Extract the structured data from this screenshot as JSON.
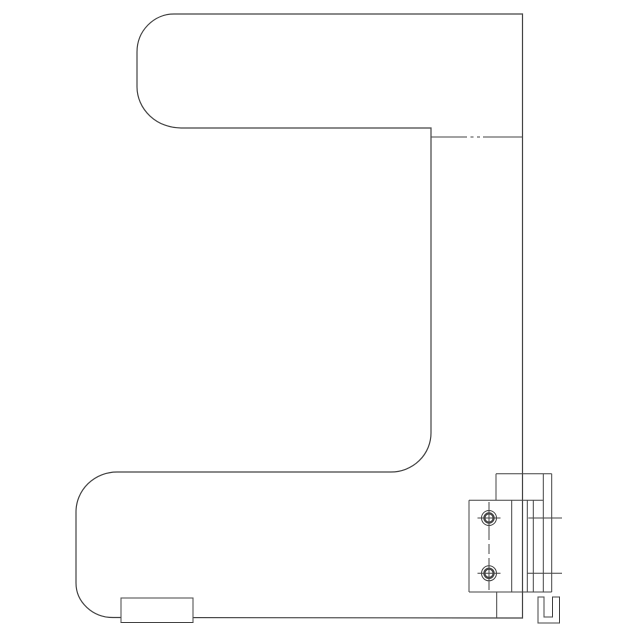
{
  "canvas": {
    "width": 640,
    "height": 640,
    "background": "#ffffff"
  },
  "style": {
    "line_color": "#444444",
    "outline_width": 1.2,
    "thin_width": 1,
    "heavy_width": 2.2,
    "white": "#ffffff"
  },
  "drawing": {
    "subject": "door-handle-side-profile-technical-drawing",
    "shapes": [
      {
        "name": "handle-outline",
        "kind": "path",
        "w": 1.2,
        "d": "M 174 14 L 522.5 14 L 522.5 618 L 113 617.5 A 37 34.5 0 0 1 76 583 L 76 512 A 41 40 0 0 1 117 472 L 391 472 A 40 39 0 0 0 431 433 L 431 128 L 181 128 A 44 41.3 0 0 1 137 87 L 137 52 A 37 38 0 0 1 174 14 Z"
      },
      {
        "name": "neck-shoulder-line-left",
        "kind": "line",
        "x1": 431,
        "y1": 137,
        "x2": 467,
        "y2": 137
      },
      {
        "name": "neck-shoulder-dash-a",
        "kind": "line",
        "x1": 470.5,
        "y1": 137,
        "x2": 473.5,
        "y2": 137
      },
      {
        "name": "neck-shoulder-dash-b",
        "kind": "line",
        "x1": 477,
        "y1": 137,
        "x2": 480,
        "y2": 137
      },
      {
        "name": "neck-shoulder-line-right",
        "kind": "line",
        "x1": 483,
        "y1": 137,
        "x2": 522,
        "y2": 137
      },
      {
        "name": "bracket-cap-top-line",
        "kind": "line",
        "x1": 496,
        "y1": 473.7,
        "x2": 551.7,
        "y2": 473.7
      },
      {
        "name": "bracket-cap-left-line",
        "kind": "line",
        "x1": 496,
        "y1": 473.7,
        "x2": 496,
        "y2": 500.3
      },
      {
        "name": "bracket-outer-right-line",
        "kind": "line",
        "x1": 551.7,
        "y1": 473.7,
        "x2": 551.7,
        "y2": 592
      },
      {
        "name": "bracket-inner-right-line",
        "kind": "line",
        "x1": 543.3,
        "y1": 473.7,
        "x2": 543.3,
        "y2": 592
      },
      {
        "name": "bracket-left-lower-line",
        "kind": "line",
        "x1": 496.7,
        "y1": 592,
        "x2": 496.7,
        "y2": 618
      },
      {
        "name": "mounting-plate-top-edge",
        "kind": "line",
        "x1": 469,
        "y1": 500.3,
        "x2": 543.3,
        "y2": 500.3
      },
      {
        "name": "mounting-plate-left-edge",
        "kind": "line",
        "x1": 469,
        "y1": 500.3,
        "x2": 469,
        "y2": 592
      },
      {
        "name": "mounting-plate-bottom-edge",
        "kind": "line",
        "x1": 469,
        "y1": 592,
        "x2": 551.7,
        "y2": 592
      },
      {
        "name": "mounting-plate-inner-line-1",
        "kind": "line",
        "x1": 511.7,
        "y1": 500.3,
        "x2": 511.7,
        "y2": 592
      },
      {
        "name": "mounting-plate-inner-line-2",
        "kind": "line",
        "x1": 527.3,
        "y1": 500.3,
        "x2": 527.3,
        "y2": 592
      },
      {
        "name": "mounting-plate-inner-line-3",
        "kind": "line",
        "x1": 533.3,
        "y1": 500.3,
        "x2": 533.3,
        "y2": 592
      },
      {
        "name": "screw-centerline",
        "kind": "line",
        "x1": 489,
        "y1": 502,
        "x2": 489,
        "y2": 590,
        "dash": "10 4"
      },
      {
        "name": "screw-top-outer-circle",
        "kind": "circle",
        "cx": 489,
        "cy": 518,
        "r": 7.5
      },
      {
        "name": "screw-top-inner-circle",
        "kind": "circle",
        "cx": 489,
        "cy": 518,
        "r": 4.6,
        "w": 2.2
      },
      {
        "name": "screw-top-centermark-h",
        "kind": "line",
        "x1": 477.5,
        "y1": 518,
        "x2": 500.5,
        "y2": 518
      },
      {
        "name": "screw-top-centermark-v",
        "kind": "line",
        "x1": 489,
        "y1": 504,
        "x2": 489,
        "y2": 532
      },
      {
        "name": "screw-bottom-outer-circle",
        "kind": "circle",
        "cx": 489,
        "cy": 573.3,
        "r": 7.5
      },
      {
        "name": "screw-bottom-inner-circle",
        "kind": "circle",
        "cx": 489,
        "cy": 573.3,
        "r": 4.6,
        "w": 2.2
      },
      {
        "name": "screw-bottom-centermark-h",
        "kind": "line",
        "x1": 477.5,
        "y1": 573.3,
        "x2": 500.5,
        "y2": 573.3
      },
      {
        "name": "screw-bottom-centermark-v",
        "kind": "line",
        "x1": 489,
        "y1": 559.3,
        "x2": 489,
        "y2": 587.3
      },
      {
        "name": "screw-top-extension-line",
        "kind": "line",
        "x1": 528.3,
        "y1": 518,
        "x2": 562,
        "y2": 518
      },
      {
        "name": "screw-bottom-extension-line",
        "kind": "line",
        "x1": 527.3,
        "y1": 573.3,
        "x2": 562,
        "y2": 573.3
      },
      {
        "name": "bottom-channel-profile",
        "kind": "path",
        "d": "M 538 597 L 538 623 L 559.5 623 L 559.5 597 L 552.5 597 L 552.5 617 L 544 617 L 544 597 Z"
      },
      {
        "name": "base-end-cap",
        "kind": "rect",
        "x": 121,
        "y": 598,
        "width": 72,
        "height": 24.5,
        "fill": "#ffffff"
      }
    ]
  }
}
